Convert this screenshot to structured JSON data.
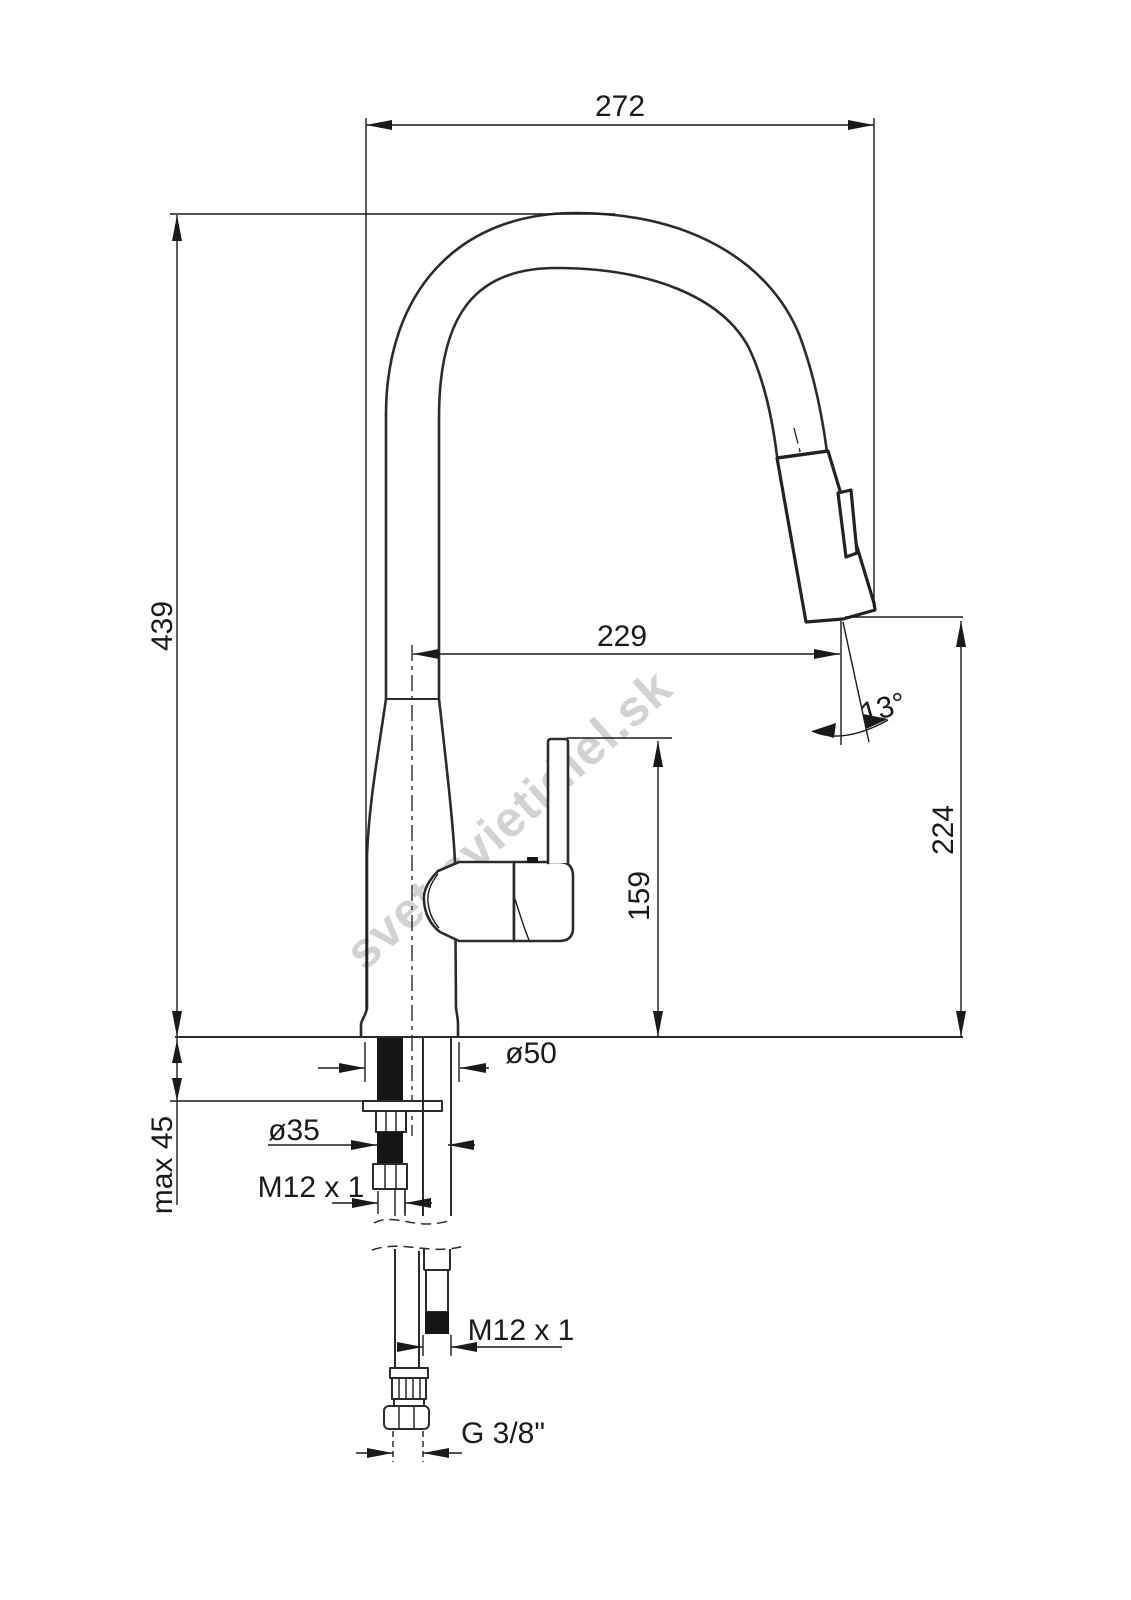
{
  "drawing": {
    "type": "technical dimension drawing",
    "subject": "kitchen faucet with pull-out spray head",
    "watermark": "svet-svietidiel.sk",
    "colors": {
      "line": "#2b2b2b",
      "background": "#ffffff",
      "watermark": "#cbcbcb"
    },
    "labels": {
      "overall_width": "272",
      "overall_height": "439",
      "spout_reach": "229",
      "spray_angle": "13°",
      "outlet_height": "224",
      "handle_height": "159",
      "base_diameter": "ø50",
      "hole_diameter": "ø35",
      "max_deck_thickness": "max 45",
      "stud_thread": "M12 x 1",
      "hose_thread": "M12 x 1",
      "supply_thread": "G 3/8\""
    }
  }
}
